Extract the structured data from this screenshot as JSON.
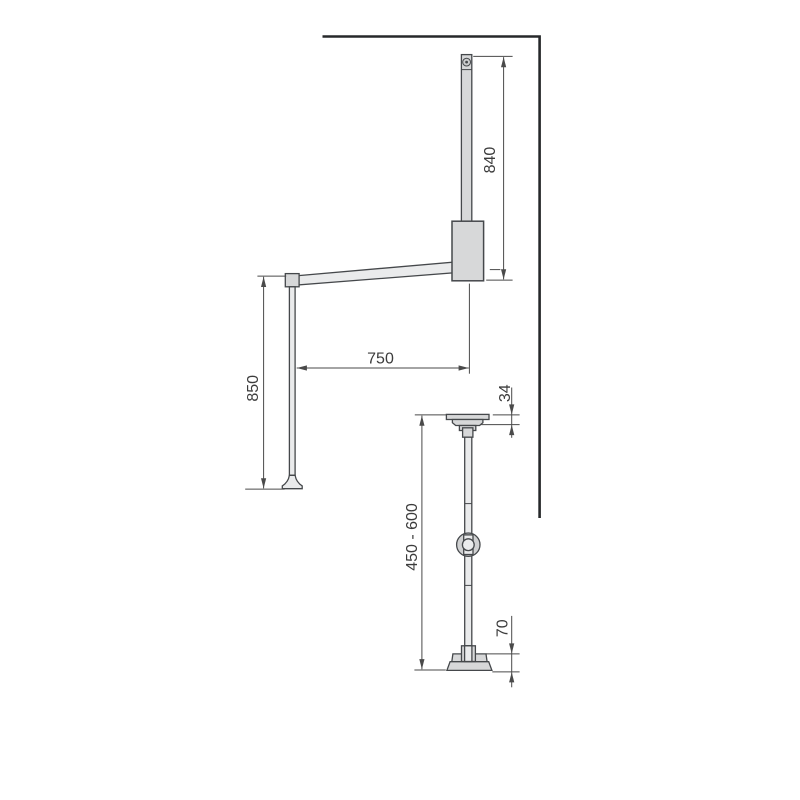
{
  "drawing": {
    "kind": "technical-dimension-drawing",
    "labels": {
      "bar_height": "840",
      "arm_length": "750",
      "handle_length": "850",
      "head_height": "34",
      "column_range": "450 - 600",
      "base_height": "70"
    }
  },
  "colors": {
    "background": "#ffffff",
    "wall": "#26282a",
    "part-outline": "#45484b",
    "part-fill": "#d7d8d9",
    "part-fill-light": "#eaebec",
    "dim-line": "#4a4a4a",
    "text": "#3c3c3c"
  }
}
